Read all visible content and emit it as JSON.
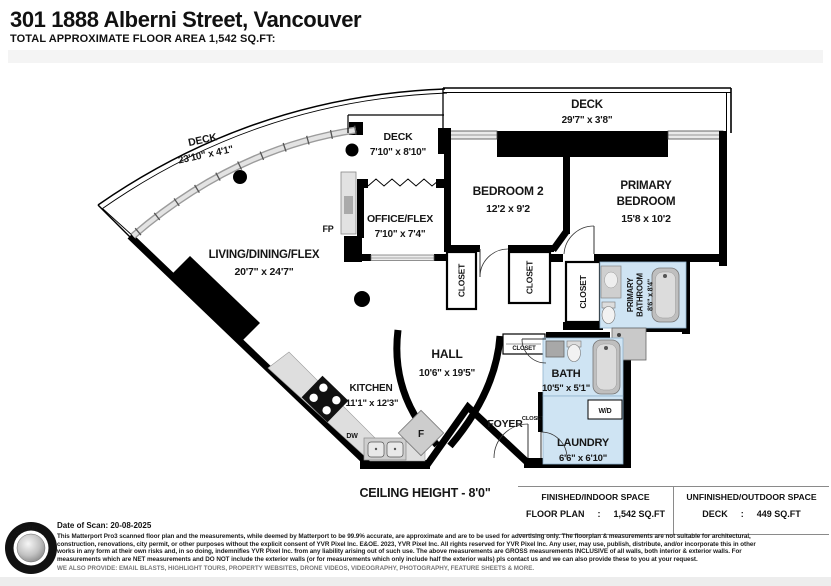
{
  "header": {
    "title": "301 1888 Alberni Street, Vancouver",
    "subtitle": "TOTAL APPROXIMATE FLOOR AREA 1,542 SQ.FT:"
  },
  "plan": {
    "ceiling": "CEILING HEIGHT - 8'0\"",
    "deck_top": {
      "name": "DECK",
      "dims": "29'7\" x 3'8\""
    },
    "deck_left": {
      "name": "DECK",
      "dims": "23'10\" x 4'1\""
    },
    "deck_mid": {
      "name": "DECK",
      "dims": "7'10\" x 8'10\""
    },
    "living": {
      "name": "LIVING/DINING/FLEX",
      "dims": "20'7\" x 24'7\""
    },
    "office": {
      "name": "OFFICE/FLEX",
      "dims": "7'10\" x 7'4\""
    },
    "bedroom2": {
      "name": "BEDROOM 2",
      "dims": "12'2 x 9'2"
    },
    "primary": {
      "name1": "PRIMARY",
      "name2": "BEDROOM",
      "dims": "15'8 x 10'2"
    },
    "primary_bath": {
      "name1": "PRIMARY",
      "name2": "BATHROOM",
      "dims": "8'6\" x 8'4\""
    },
    "hall": {
      "name": "HALL",
      "dims": "10'6\" x 19'5\""
    },
    "kitchen": {
      "name": "KITCHEN",
      "dims": "11'1\" x 12'3\""
    },
    "bath": {
      "name": "BATH",
      "dims": "10'5\" x 5'1\""
    },
    "foyer": {
      "name": "FOYER"
    },
    "laundry": {
      "name": "LAUNDRY",
      "dims": "6'6\" x 6'10\""
    },
    "labels": {
      "closet": "CLOSET",
      "fp": "FP",
      "dw": "DW",
      "fridge": "F",
      "wd": "W/D"
    }
  },
  "areas": {
    "indoor": {
      "heading": "FINISHED/INDOOR SPACE",
      "label": "FLOOR PLAN",
      "colon": ":",
      "value": "1,542 SQ.FT"
    },
    "outdoor": {
      "heading": "UNFINISHED/OUTDOOR SPACE",
      "label": "DECK",
      "colon": ":",
      "value": "449 SQ.FT"
    }
  },
  "footer": {
    "logo": "YVR PIXEL",
    "date": "Date of Scan: 20-08-2025",
    "disclaimer": [
      "This Matterport Pro3 scanned floor plan and the measurements, while deemed by Matterport to be 99.9% accurate, are approximate and are to be used for advertising only. The floorplan & measurements are not suitable for architectural,",
      "construction, renovations, city permit, or other purposes without the explicit consent of YVR Pixel Inc. E&OE. 2023, YVR Pixel Inc. All rights reserved for YVR Pixel Inc. Any user, may use, publish, distribute, and/or incorporate this in other",
      "works in any form at their own risks and, in so doing, indemnifies YVR Pixel Inc. from any liability arising out of such use. The above measurements are GROSS measurements INCLUSIVE of all walls, both interior & exterior walls. For",
      "measurements which are NET measurements and DO NOT include the exterior walls (or for measurements which only include half the exterior walls) pls contact us and we can also provide these to you at your request."
    ],
    "provide": "WE ALSO PROVIDE: EMAIL BLASTS, HIGHLIGHT TOURS, PROPERTY WEBSITES, DRONE VIDEOS, VIDEOGRAPHY, PHOTOGRAPHY, FEATURE SHEETS & MORE."
  }
}
